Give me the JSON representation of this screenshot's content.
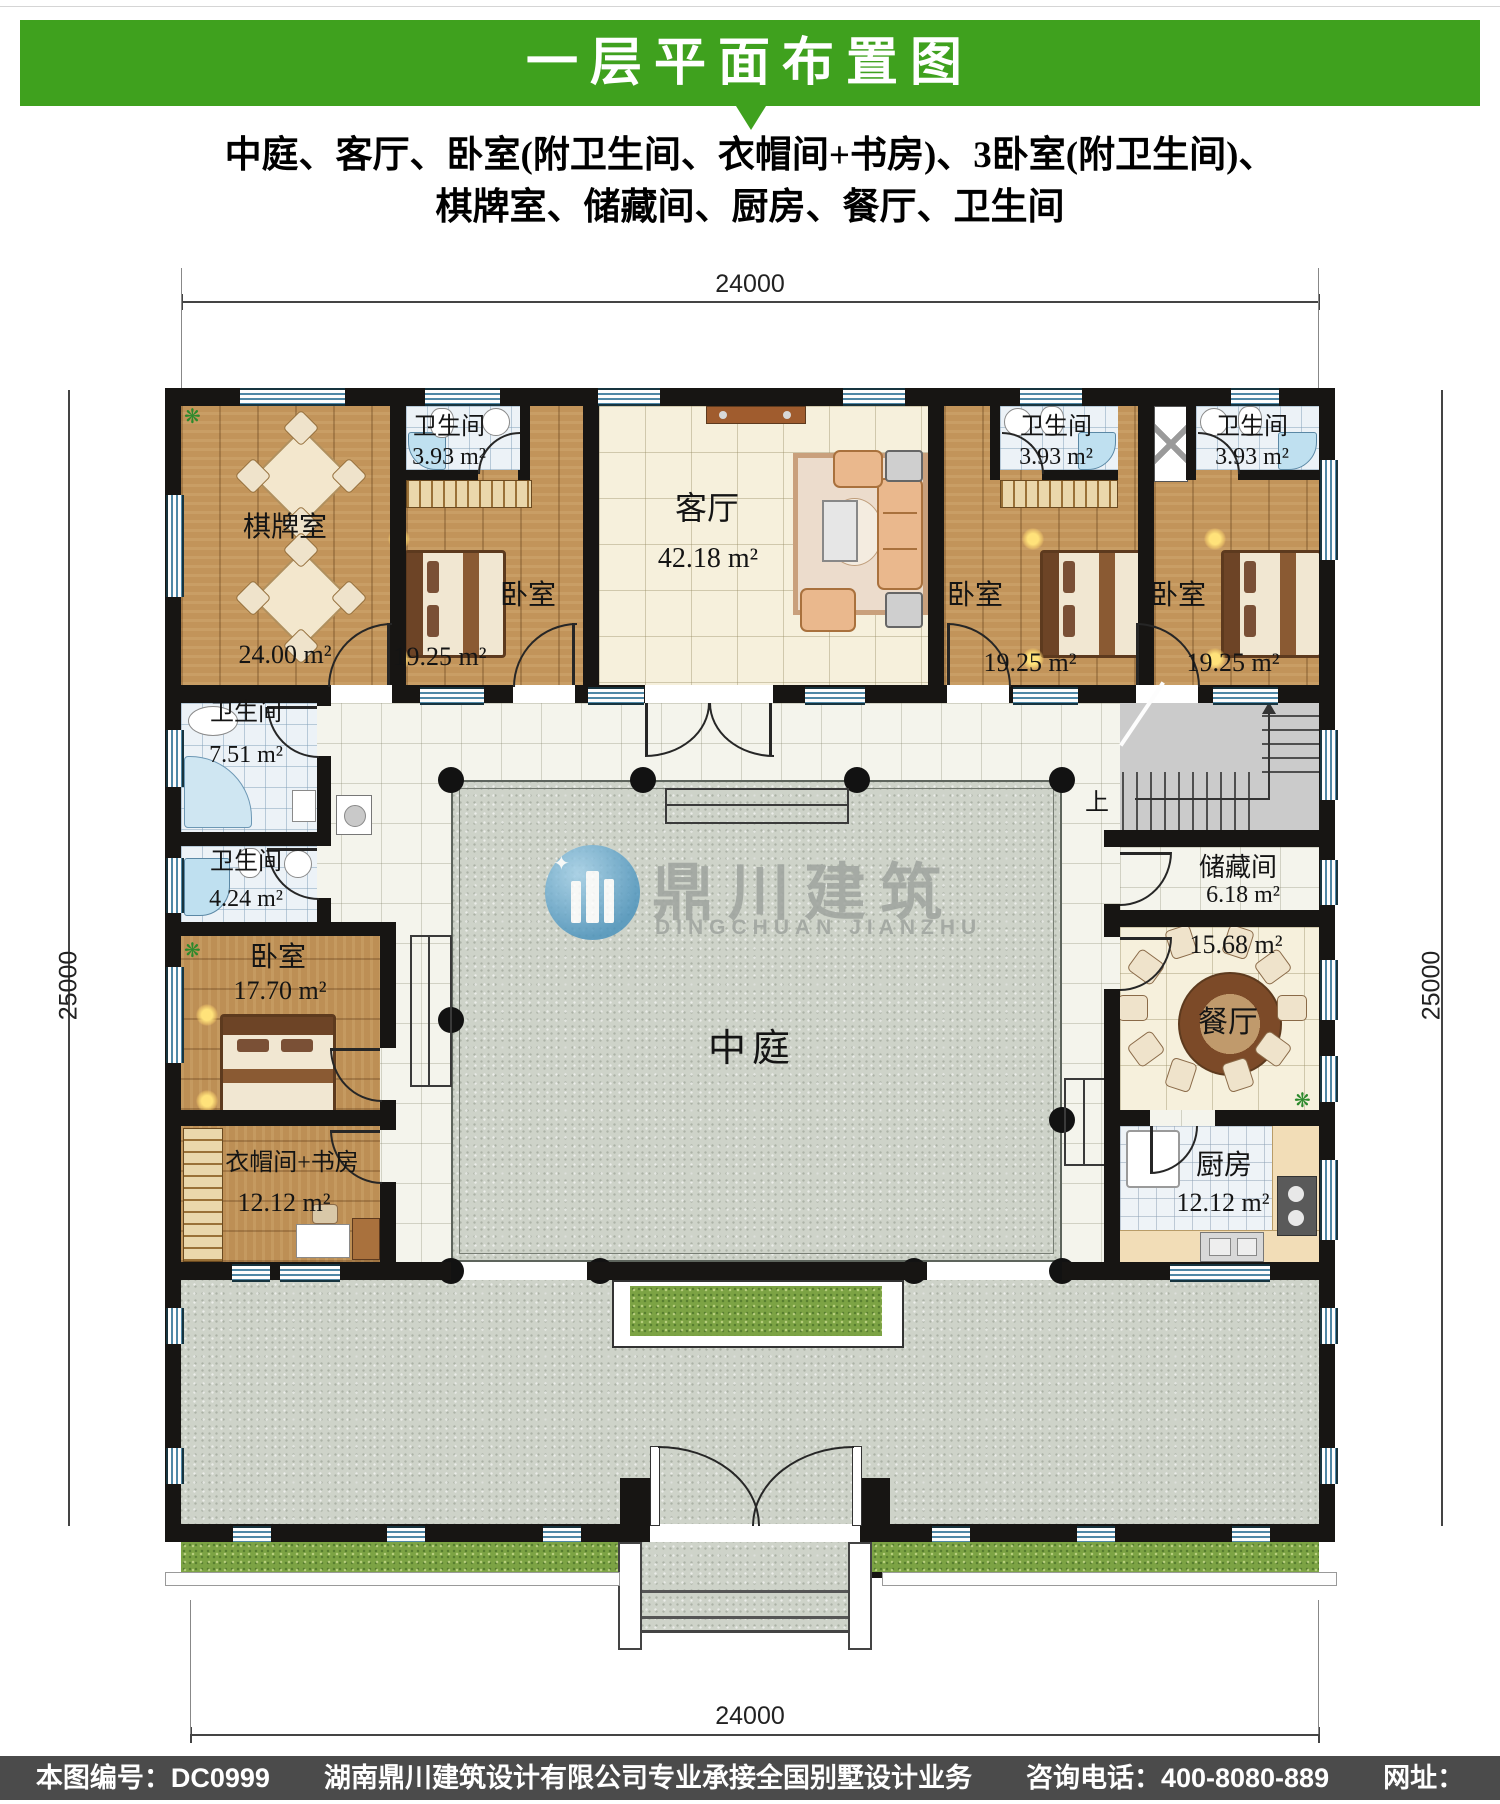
{
  "header": {
    "title": "一层平面布置图"
  },
  "subtitle": {
    "line1": "中庭、客厅、卧室(附卫生间、衣帽间+书房)、3卧室(附卫生间)、",
    "line2": "棋牌室、储藏间、厨房、餐厅、卫生间"
  },
  "dimensions": {
    "top": "24000",
    "bottom": "24000",
    "left": "25000",
    "right": "25000"
  },
  "rooms": {
    "qipai": {
      "name": "棋牌室",
      "area": "24.00 m²"
    },
    "bath1": {
      "name": "卫生间",
      "area": "3.93 m²"
    },
    "bath2": {
      "name": "卫生间",
      "area": "3.93 m²"
    },
    "bath3": {
      "name": "卫生间",
      "area": "3.93 m²"
    },
    "bed1": {
      "name": "卧室",
      "area": "19.25 m²"
    },
    "bed2": {
      "name": "卧室",
      "area": "19.25 m²"
    },
    "bed3": {
      "name": "卧室",
      "area": "19.25 m²"
    },
    "living": {
      "name": "客厅",
      "area": "42.18 m²"
    },
    "bath4": {
      "name": "卫生间",
      "area": "7.51 m²"
    },
    "bath5": {
      "name": "卫生间",
      "area": "4.24 m²"
    },
    "bed4": {
      "name": "卧室",
      "area": "17.70 m²"
    },
    "cloak": {
      "name": "衣帽间+书房",
      "area": "12.12 m²"
    },
    "storage": {
      "name": "储藏间",
      "area": "6.18 m²"
    },
    "dining": {
      "name": "餐厅",
      "area": "15.68 m²"
    },
    "kitchen": {
      "name": "厨房",
      "area": "12.12 m²"
    },
    "courtyard": {
      "name": "中庭"
    }
  },
  "stairs": {
    "up_label": "上"
  },
  "watermark": {
    "cn": "鼎川建筑",
    "en": "DINGCHUAN JIANZHU"
  },
  "footer": {
    "text": "本图编号：DC0999　　湖南鼎川建筑设计有限公司专业承接全国别墅设计业务　　咨询电话：400-8080-889　　网址：www.bstzcs.com"
  },
  "colors": {
    "header_green": "#3fa11e",
    "wall": "#171513",
    "window_blue": "#4e87a6",
    "grass": "#7ca344",
    "footer_gray": "#4b4b4b"
  },
  "icons": {
    "plant": "❋"
  }
}
